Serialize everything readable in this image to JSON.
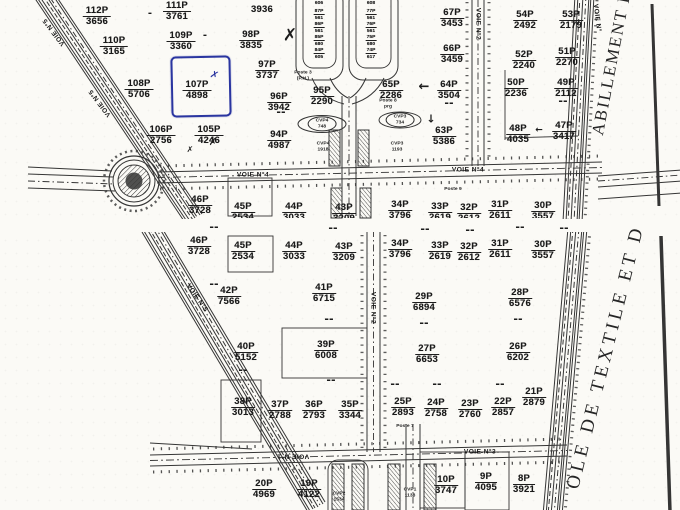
{
  "map": {
    "type": "scanned-cadastral-plan",
    "ink_color": "#1c1c1c",
    "paper_color": "#fbfaf6",
    "highlight_color": "#2a35a0",
    "highlighted_parcel": "107P 4898"
  },
  "margin_text": {
    "upper": "ABILLEMENT D",
    "lower": "OLE DE TEXTILE ET D"
  },
  "parcels_top": [
    {
      "num": "112P",
      "area": "3656",
      "x": 97,
      "y": 6
    },
    {
      "num": "111P",
      "area": "3761",
      "x": 177,
      "y": 1
    },
    {
      "num": "",
      "area": "3936",
      "x": 262,
      "y": 4
    },
    {
      "num": "98P",
      "area": "3835",
      "x": 251,
      "y": 30
    },
    {
      "num": "110P",
      "area": "3165",
      "x": 114,
      "y": 36
    },
    {
      "num": "109P",
      "area": "3360",
      "x": 181,
      "y": 31
    },
    {
      "num": "97P",
      "area": "3737",
      "x": 267,
      "y": 60
    },
    {
      "num": "108P",
      "area": "5706",
      "x": 139,
      "y": 79
    },
    {
      "num": "107P",
      "area": "4898",
      "x": 197,
      "y": 80
    },
    {
      "num": "96P",
      "area": "3942",
      "x": 279,
      "y": 92
    },
    {
      "num": "95P",
      "area": "2290",
      "x": 322,
      "y": 86
    },
    {
      "num": "65P",
      "area": "2286",
      "x": 391,
      "y": 80
    },
    {
      "num": "106P",
      "area": "2756",
      "x": 161,
      "y": 125
    },
    {
      "num": "105P",
      "area": "4246",
      "x": 209,
      "y": 125
    },
    {
      "num": "94P",
      "area": "4987",
      "x": 279,
      "y": 130
    },
    {
      "num": "63P",
      "area": "5386",
      "x": 444,
      "y": 126
    },
    {
      "num": "67P",
      "area": "3453",
      "x": 452,
      "y": 8
    },
    {
      "num": "66P",
      "area": "3459",
      "x": 452,
      "y": 44
    },
    {
      "num": "64P",
      "area": "3504",
      "x": 449,
      "y": 80
    },
    {
      "num": "54P",
      "area": "2492",
      "x": 525,
      "y": 10
    },
    {
      "num": "53P",
      "area": "2179",
      "x": 571,
      "y": 10
    },
    {
      "num": "52P",
      "area": "2240",
      "x": 524,
      "y": 50
    },
    {
      "num": "51P",
      "area": "2270",
      "x": 567,
      "y": 47
    },
    {
      "num": "50P",
      "area": "2236",
      "x": 516,
      "y": 78
    },
    {
      "num": "49P",
      "area": "2112",
      "x": 566,
      "y": 78
    },
    {
      "num": "48P",
      "area": "4035",
      "x": 518,
      "y": 124
    },
    {
      "num": "47P",
      "area": "3417",
      "x": 564,
      "y": 121
    }
  ],
  "parcels_top_dup": [
    {
      "num": "46P",
      "area": "3728",
      "x": 200,
      "y": 195
    },
    {
      "num": "45P",
      "area": "2534",
      "x": 243,
      "y": 202
    },
    {
      "num": "44P",
      "area": "3033",
      "x": 294,
      "y": 202
    },
    {
      "num": "43P",
      "area": "3209",
      "x": 344,
      "y": 203
    },
    {
      "num": "34P",
      "area": "3796",
      "x": 400,
      "y": 200
    },
    {
      "num": "33P",
      "area": "2619",
      "x": 440,
      "y": 202
    },
    {
      "num": "32P",
      "area": "2612",
      "x": 469,
      "y": 203
    },
    {
      "num": "31P",
      "area": "2611",
      "x": 500,
      "y": 200
    },
    {
      "num": "30P",
      "area": "3557",
      "x": 543,
      "y": 201
    }
  ],
  "parcels_bottom": [
    {
      "num": "46P",
      "area": "3728",
      "x": 199,
      "y": 236
    },
    {
      "num": "45P",
      "area": "2534",
      "x": 243,
      "y": 241
    },
    {
      "num": "44P",
      "area": "3033",
      "x": 294,
      "y": 241
    },
    {
      "num": "43P",
      "area": "3209",
      "x": 344,
      "y": 242
    },
    {
      "num": "34P",
      "area": "3796",
      "x": 400,
      "y": 239
    },
    {
      "num": "33P",
      "area": "2619",
      "x": 440,
      "y": 241
    },
    {
      "num": "32P",
      "area": "2612",
      "x": 469,
      "y": 242
    },
    {
      "num": "31P",
      "area": "2611",
      "x": 500,
      "y": 239
    },
    {
      "num": "30P",
      "area": "3557",
      "x": 543,
      "y": 240
    },
    {
      "num": "42P",
      "area": "7566",
      "x": 229,
      "y": 286
    },
    {
      "num": "41P",
      "area": "6715",
      "x": 324,
      "y": 283
    },
    {
      "num": "29P",
      "area": "6894",
      "x": 424,
      "y": 292
    },
    {
      "num": "28P",
      "area": "6576",
      "x": 520,
      "y": 288
    },
    {
      "num": "40P",
      "area": "5152",
      "x": 246,
      "y": 342
    },
    {
      "num": "39P",
      "area": "6008",
      "x": 326,
      "y": 340
    },
    {
      "num": "27P",
      "area": "6653",
      "x": 427,
      "y": 344
    },
    {
      "num": "26P",
      "area": "6202",
      "x": 518,
      "y": 342
    },
    {
      "num": "38P",
      "area": "3013",
      "x": 243,
      "y": 397
    },
    {
      "num": "37P",
      "area": "2788",
      "x": 280,
      "y": 400
    },
    {
      "num": "36P",
      "area": "2793",
      "x": 314,
      "y": 400
    },
    {
      "num": "35P",
      "area": "3344",
      "x": 350,
      "y": 400
    },
    {
      "num": "25P",
      "area": "2893",
      "x": 403,
      "y": 397
    },
    {
      "num": "24P",
      "area": "2758",
      "x": 436,
      "y": 398
    },
    {
      "num": "23P",
      "area": "2760",
      "x": 470,
      "y": 399
    },
    {
      "num": "22P",
      "area": "2857",
      "x": 503,
      "y": 397
    },
    {
      "num": "21P",
      "area": "2879",
      "x": 534,
      "y": 387
    },
    {
      "num": "20P",
      "area": "4969",
      "x": 264,
      "y": 479
    },
    {
      "num": "19P",
      "area": "4122",
      "x": 309,
      "y": 479
    },
    {
      "num": "10P",
      "area": "3747",
      "x": 446,
      "y": 475
    },
    {
      "num": "9P",
      "area": "4095",
      "x": 486,
      "y": 472
    },
    {
      "num": "8P",
      "area": "3921",
      "x": 524,
      "y": 474
    }
  ],
  "strip_left": [
    {
      "num": "",
      "area": "606",
      "x": 319,
      "y": 0
    },
    {
      "num": "87P",
      "area": "561",
      "x": 319,
      "y": 9
    },
    {
      "num": "86P",
      "area": "561",
      "x": 319,
      "y": 22
    },
    {
      "num": "85P",
      "area": "680",
      "x": 319,
      "y": 35
    },
    {
      "num": "84P",
      "area": "605",
      "x": 319,
      "y": 48
    }
  ],
  "strip_right": [
    {
      "num": "",
      "area": "608",
      "x": 371,
      "y": 0
    },
    {
      "num": "77P",
      "area": "561",
      "x": 371,
      "y": 9
    },
    {
      "num": "76P",
      "area": "561",
      "x": 371,
      "y": 22
    },
    {
      "num": "75P",
      "area": "680",
      "x": 371,
      "y": 35
    },
    {
      "num": "74P",
      "area": "617",
      "x": 371,
      "y": 48
    }
  ],
  "small_labels": [
    {
      "t1": "Poste 3",
      "t2": "(P.H.)",
      "x": 303,
      "y": 76
    },
    {
      "t1": "Poste 8",
      "t2": "prg",
      "x": 388,
      "y": 104
    },
    {
      "t1": "CVP4",
      "t2": "748",
      "x": 322,
      "y": 124,
      "oval": 1
    },
    {
      "t1": "CVP3",
      "t2": "734",
      "x": 400,
      "y": 120,
      "oval": 1
    },
    {
      "t1": "CVP4",
      "t2": "1918",
      "x": 323,
      "y": 147
    },
    {
      "t1": "CVP3",
      "t2": "1193",
      "x": 397,
      "y": 147
    },
    {
      "t1": "Poste 9",
      "t2": "",
      "x": 453,
      "y": 190
    },
    {
      "t1": "Poste 7",
      "t2": "",
      "x": 405,
      "y": 427
    },
    {
      "t1": "CVP2",
      "t2": "1534",
      "x": 339,
      "y": 497
    },
    {
      "t1": "CVP1",
      "t2": "1138",
      "x": 410,
      "y": 493
    }
  ],
  "road_labels": [
    {
      "text": "VOIE N°4",
      "x": 253,
      "y": 175
    },
    {
      "text": "VOIE N°4",
      "x": 468,
      "y": 170
    },
    {
      "text": "VOIE N°2",
      "x": 478,
      "y": 24,
      "rot": 90
    },
    {
      "text": "VOIE N°5",
      "x": 54,
      "y": 32,
      "rot": 233
    },
    {
      "text": "VOIE N°5",
      "x": 100,
      "y": 103,
      "rot": 233
    },
    {
      "text": "VOIE N°",
      "x": 597,
      "y": 18,
      "rot": 83
    },
    {
      "text": "VOIE N°2",
      "x": 373,
      "y": 308,
      "rot": 90
    },
    {
      "text": "VOIE N°5",
      "x": 197,
      "y": 298,
      "rot": 55
    },
    {
      "text": "VOIE N°1",
      "x": 293,
      "y": 456,
      "rot": 180
    },
    {
      "text": "VOIE N°3",
      "x": 480,
      "y": 452
    }
  ],
  "marks": [
    {
      "g": "✗",
      "x": 290,
      "y": 36,
      "s": 17
    },
    {
      "g": "✗",
      "x": 213,
      "y": 143,
      "s": 10
    },
    {
      "g": "✗",
      "x": 190,
      "y": 150,
      "s": 8
    },
    {
      "g": "✗",
      "x": 214,
      "y": 76,
      "s": 10,
      "c": "#2a35a0",
      "rot": 18
    },
    {
      "g": "←",
      "x": 424,
      "y": 87,
      "s": 13
    },
    {
      "g": "↓",
      "x": 431,
      "y": 119,
      "s": 11
    },
    {
      "g": "←",
      "x": 539,
      "y": 131,
      "s": 9
    },
    {
      "g": "-",
      "x": 150,
      "y": 14,
      "s": 10
    },
    {
      "g": "-",
      "x": 205,
      "y": 36,
      "s": 10
    },
    {
      "g": "--",
      "x": 449,
      "y": 103,
      "s": 11
    },
    {
      "g": "--",
      "x": 563,
      "y": 101,
      "s": 11
    },
    {
      "g": "--",
      "x": 281,
      "y": 112,
      "s": 11
    },
    {
      "g": "--",
      "x": 214,
      "y": 227,
      "s": 11
    },
    {
      "g": "--",
      "x": 333,
      "y": 228,
      "s": 11
    },
    {
      "g": "--",
      "x": 425,
      "y": 229,
      "s": 11
    },
    {
      "g": "--",
      "x": 470,
      "y": 230,
      "s": 11
    },
    {
      "g": "--",
      "x": 520,
      "y": 227,
      "s": 11
    },
    {
      "g": "--",
      "x": 564,
      "y": 228,
      "s": 11
    },
    {
      "g": "--",
      "x": 214,
      "y": 284,
      "s": 11
    },
    {
      "g": "--",
      "x": 329,
      "y": 319,
      "s": 11
    },
    {
      "g": "--",
      "x": 424,
      "y": 323,
      "s": 11
    },
    {
      "g": "--",
      "x": 518,
      "y": 319,
      "s": 11
    },
    {
      "g": "--",
      "x": 243,
      "y": 370,
      "s": 11
    },
    {
      "g": "--",
      "x": 331,
      "y": 380,
      "s": 11
    },
    {
      "g": "--",
      "x": 395,
      "y": 384,
      "s": 11
    },
    {
      "g": "--",
      "x": 437,
      "y": 384,
      "s": 11
    },
    {
      "g": "--",
      "x": 500,
      "y": 384,
      "s": 11
    }
  ]
}
